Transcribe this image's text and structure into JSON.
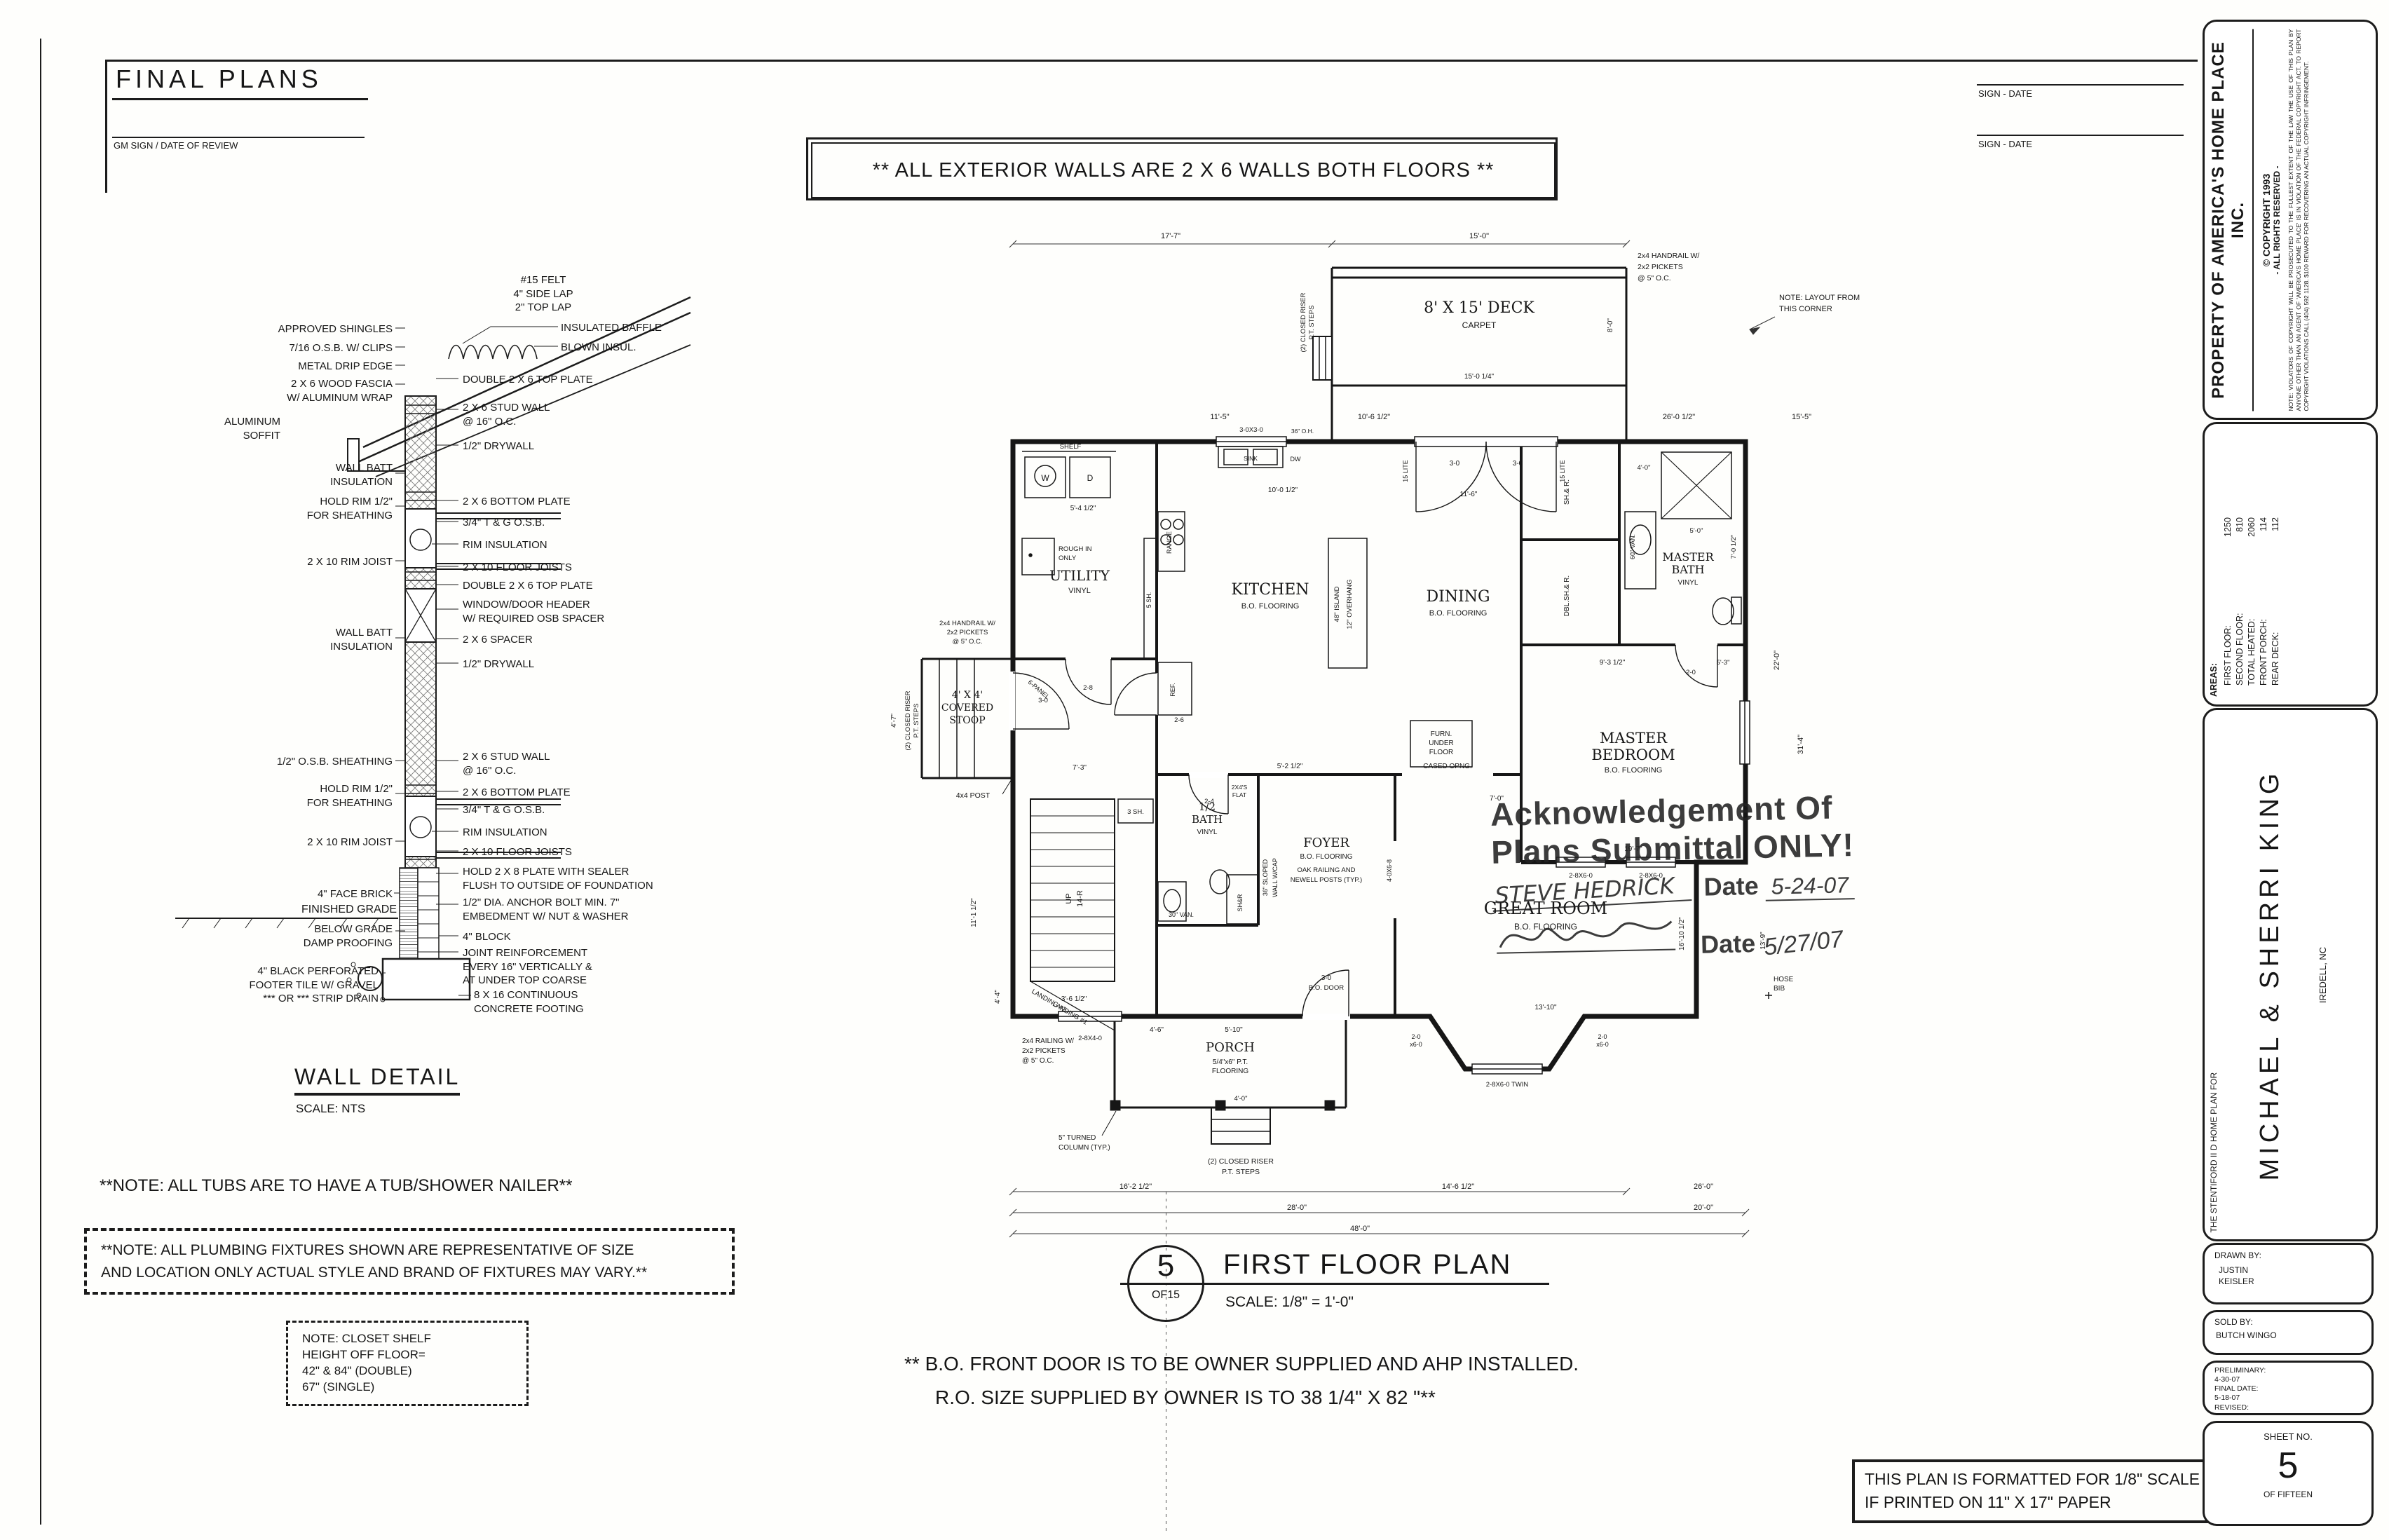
{
  "hdr": {
    "title": "FINAL PLANS",
    "gm": "GM SIGN / DATE OF REVIEW",
    "banner": "**  ALL EXTERIOR WALLS ARE 2 X 6 WALLS BOTH FLOORS  **",
    "sign1": "SIGN - DATE",
    "sign2": "SIGN - DATE"
  },
  "wd": {
    "title": "WALL DETAIL",
    "scale": "SCALE: NTS",
    "top": "#15 FELT\n4\" SIDE LAP\n2\" TOP LAP",
    "l1": "APPROVED SHINGLES",
    "l2": "7/16 O.S.B. W/ CLIPS",
    "l3": "METAL DRIP EDGE",
    "l4": "2 X 6 WOOD FASCIA\nW/ ALUMINUM WRAP",
    "l5": "ALUMINUM\nSOFFIT",
    "l6": "WALL BATT\nINSULATION",
    "l7": "HOLD RIM 1/2\"\nFOR SHEATHING",
    "l8": "2 X 10 RIM JOIST",
    "l9": "WALL BATT\nINSULATION",
    "l10": "1/2\" O.S.B. SHEATHING",
    "l11": "HOLD RIM 1/2\"\nFOR SHEATHING",
    "l12": "2 X 10 RIM JOIST",
    "l13": "4\" FACE BRICK",
    "l14": "FINISHED GRADE",
    "l15": "BELOW GRADE\nDAMP PROOFING",
    "l16": "4\" BLACK PERFORATED\nFOOTER TILE W/ GRAVEL\n*** OR *** STRIP DRAIN",
    "r1": "INSULATED BAFFLE",
    "r2": "BLOWN INSUL.",
    "r3": "DOUBLE 2 X 6 TOP PLATE",
    "r4": "2 X 6 STUD WALL\n@ 16\" O.C.",
    "r5": "1/2\" DRYWALL",
    "r6": "2 X 6 BOTTOM PLATE",
    "r7": "3/4\" T & G O.S.B.",
    "r8": "RIM INSULATION",
    "r9": "2 X 10 FLOOR JOISTS",
    "r10": "DOUBLE 2 X 6 TOP PLATE",
    "r11": "WINDOW/DOOR HEADER\nW/ REQUIRED OSB SPACER",
    "r12": "2 X 6 SPACER",
    "r13": "1/2\" DRYWALL",
    "r14": "2 X 6 STUD WALL\n@ 16\" O.C.",
    "r15": "2 X 6 BOTTOM PLATE",
    "r16": "3/4\" T & G O.S.B.",
    "r17": "RIM INSULATION",
    "r18": "2 X 10 FLOOR JOISTS",
    "r19": "HOLD 2 X 8 PLATE WITH SEALER\nFLUSH TO OUTSIDE OF FOUNDATION",
    "r20": "1/2\" DIA. ANCHOR BOLT MIN. 7\"\nEMBEDMENT W/ NUT & WASHER",
    "r21": "4\" BLOCK",
    "r22": "JOINT REINFORCEMENT\nEVERY 16\" VERTICALLY &\nAT UNDER TOP COARSE",
    "r23": "8 X 16 CONTINUOUS\nCONCRETE FOOTING"
  },
  "notes": {
    "tub": "**NOTE:  ALL TUBS ARE TO HAVE A TUB/SHOWER NAILER**",
    "plumb": "**NOTE:  ALL PLUMBING FIXTURES SHOWN ARE REPRESENTATIVE OF SIZE\nAND LOCATION ONLY ACTUAL STYLE AND BRAND OF FIXTURES MAY VARY.**",
    "closet": "NOTE: CLOSET SHELF\nHEIGHT OFF FLOOR=\n42\" & 84\" (DOUBLE)\n67\" (SINGLE)",
    "bo1": "** B.O. FRONT DOOR IS TO BE OWNER SUPPLIED AND AHP INSTALLED.",
    "bo2": "R.O.  SIZE SUPPLIED BY OWNER IS TO 38 1/4\" X 82  \"**",
    "fmt": "THIS PLAN IS FORMATTED FOR 1/8\" SCALE\nIF PRINTED ON 11\" X 17\" PAPER"
  },
  "pt": {
    "num": "5",
    "of": "OF15",
    "title": "FIRST FLOOR PLAN",
    "scale": "SCALE:  1/8\" = 1'-0\""
  },
  "stamp": {
    "l1": "Acknowledgement Of",
    "l2": "Plans Submittal ONLY!",
    "name": "STEVE HEDRICK",
    "d1lbl": "Date",
    "d1": "5-24-07",
    "d2lbl": "Date",
    "d2": "5/27/07"
  },
  "sb": {
    "prop": "PROPERTY  OF  AMERICA'S  HOME  PLACE  INC.",
    "cp1": "© COPYRIGHT    1993",
    "cp2": "- ALL RIGHTS RESERVED -",
    "note": "NOTE: VIOLATORS OF COPYRIGHT WILL BE PROSECUTED TO THE FULLEST EXTENT OF THE LAW THE USE OF THIS PLAN BY ANYONE OTHER THAN AN AGENT OF 'AMERICA'S HOME PLACE' IS IN VIOLATION OF THE FEDERAL COPYRIGHT ACT. TO REPORT COPYRIGHT VIOLATIONS CALL (404) 592 1128.  $100 REWARD FOR RECOVERING AN ACTUAL COPYRIGHT INFRINGEMENT.",
    "areas_t": "AREAS:",
    "areas": [
      {
        "l": "FIRST FLOOR:",
        "v": "1250"
      },
      {
        "l": "SECOND FLOOR:",
        "v": "810"
      },
      {
        "l": "TOTAL HEATED:",
        "v": "2060"
      },
      {
        "l": "FRONT PORCH:",
        "v": "114"
      },
      {
        "l": "REAR DECK:",
        "v": "112"
      }
    ],
    "planfor": "THE  STENTIFORD II D HOME  PLAN FOR",
    "client": "MICHAEL  &  SHERRI  KING",
    "loc": "IREDELL,  NC",
    "drawn_l": "DRAWN BY:",
    "drawn": "JUSTIN\nKEISLER",
    "sold_l": "SOLD BY:",
    "sold": "BUTCH WINGO",
    "prelim_l": "PRELIMINARY:",
    "prelim": "4-30-07",
    "final_l": "FINAL DATE:",
    "final": "5-18-07",
    "rev_l": "REVISED:",
    "sheet_l": "SHEET NO.",
    "sheet": "5",
    "sheet_of": "OF FIFTEEN"
  },
  "fp": {
    "deck": {
      "l1": "8' X 15' DECK",
      "l2": "CARPET"
    },
    "handrail": {
      "l1": "2x4 HANDRAIL W/",
      "l2": "2x2 PICKETS",
      "l3": "@ 5\" O.C."
    },
    "riser": {
      "l1": "(2) CLOSED RISER",
      "l2": "P.T. STEPS"
    },
    "kitchen": {
      "n": "KITCHEN",
      "f": "B.O. FLOORING"
    },
    "dining": {
      "n": "DINING",
      "f": "B.O. FLOORING"
    },
    "utility": {
      "n": "UTILITY",
      "f": "VINYL"
    },
    "mbath": {
      "n1": "MASTER",
      "n2": "BATH",
      "f": "VINYL"
    },
    "mbed": {
      "n1": "MASTER",
      "n2": "BEDROOM",
      "f": "B.O. FLOORING"
    },
    "great": {
      "n": "GREAT ROOM",
      "f": "B.O. FLOORING"
    },
    "foyer": {
      "n": "FOYER",
      "f": "B.O. FLOORING",
      "r1": "OAK RAILING AND",
      "r2": "NEWELL POSTS (TYP.)"
    },
    "hbath": {
      "n1": "1/2",
      "n2": "BATH",
      "f": "VINYL"
    },
    "stoop": {
      "l1": "4' X 4'",
      "l2": "COVERED",
      "l3": "STOOP"
    },
    "porch": {
      "n": "PORCH",
      "f1": "5/4\"x6\" P.T.",
      "f2": "FLOORING"
    },
    "stair": {
      "up": "UP",
      "r": "14-R",
      "land1": "LANDING #1",
      "land2": "LANDING #2",
      "sh3": "3 SH.",
      "sh5": "5 SH."
    },
    "fix": {
      "shelf": "SHELF",
      "w": "W",
      "d": "D",
      "sink": "SINK",
      "dw": "DW",
      "range": "RANGE",
      "ref": "REF.",
      "rough1": "ROUGH IN",
      "rough2": "ONLY",
      "van30": "30\" VAN.",
      "van60": "60\" VAN.",
      "shr": "SH&R",
      "flat1": "2X4'S",
      "flat2": "FLAT",
      "island": "48\" ISLAND",
      "overhang": "12\" OVERHANG",
      "sloped1": "36\" SLOPED",
      "sloped2": "WALL W/CAP",
      "furn1": "FURN.",
      "furn2": "UNDER",
      "furn3": "FLOOR",
      "hose1": "HOSE",
      "hose2": "BIB",
      "shr2": "SH.& R.",
      "dblshr": "DBL.SH.& R.",
      "cased": "CASED OPNG.",
      "oh36": "36\" O.H."
    },
    "doors": {
      "d28": "2-8",
      "d26": "2-6",
      "d24": "2-4",
      "d20": "2-0",
      "d30": "3-0",
      "panel": "6-PANEL",
      "bodoor": "B.O. DOOR",
      "lite": "15 LITE",
      "post": "4x4 POST",
      "col1": "5\" TURNED",
      "col2": "COLUMN (TYP.)",
      "rail1": "2x4 RAILING W/",
      "rail2": "2x2 PICKETS",
      "rail3": "@ 5\" O.C."
    },
    "wins": {
      "w3030": "3-0X3-0",
      "w2840": "2-8X4-0",
      "w2860": "2-8X6-0",
      "twin": "2-8X6-0 TWIN",
      "w2060a": "2-0",
      "w2060b": "x6-0",
      "w4068": "4-0X6-8"
    },
    "corner": {
      "l1": "NOTE: LAYOUT FROM",
      "l2": "THIS CORNER"
    },
    "dims": {
      "t1": "17'-7\"",
      "t2": "15'-0\"",
      "r155": "15'-5\"",
      "r115": "11'-5\"",
      "r106": "10'-6 1/2\"",
      "r260": "26'-0 1/2\"",
      "dk1": "15'-0 1/4\"",
      "dk2": "8'-0\"",
      "k1": "10'-0 1/2\"",
      "k2": "5'-4 1/2\"",
      "din1": "11'-6\"",
      "mb1": "4'-0\"",
      "mb2": "5'-0\"",
      "mb3": "7'-0 1/2\"",
      "bd1": "9'-3 1/2\"",
      "bd2": "5'-3\"",
      "bd3": "19'-7\"",
      "gr1": "16'-10 1/2\"",
      "gr2": "13'-10\"",
      "fy1": "7'-3\"",
      "fy2": "5'-2 1/2\"",
      "fy3": "5'-10\"",
      "f46": "4'-6\"",
      "rt1": "22'-0\"",
      "rt2": "31'-4\"",
      "rt3": "13'-9\"",
      "lf1": "11'-1 1/2\"",
      "lf2": "4'-7\"",
      "lf3": "4'-4\"",
      "bt1": "16'-2 1/2\"",
      "bt2": "14'-6 1/2\"",
      "bt3": "26'-0\"",
      "bt4": "28'-0\"",
      "bt5": "20'-0\"",
      "bt6": "48'-0\"",
      "po1": "4'-0\"",
      "co1": "7'-0\"",
      "st1": "3'-6 1/2\""
    }
  }
}
